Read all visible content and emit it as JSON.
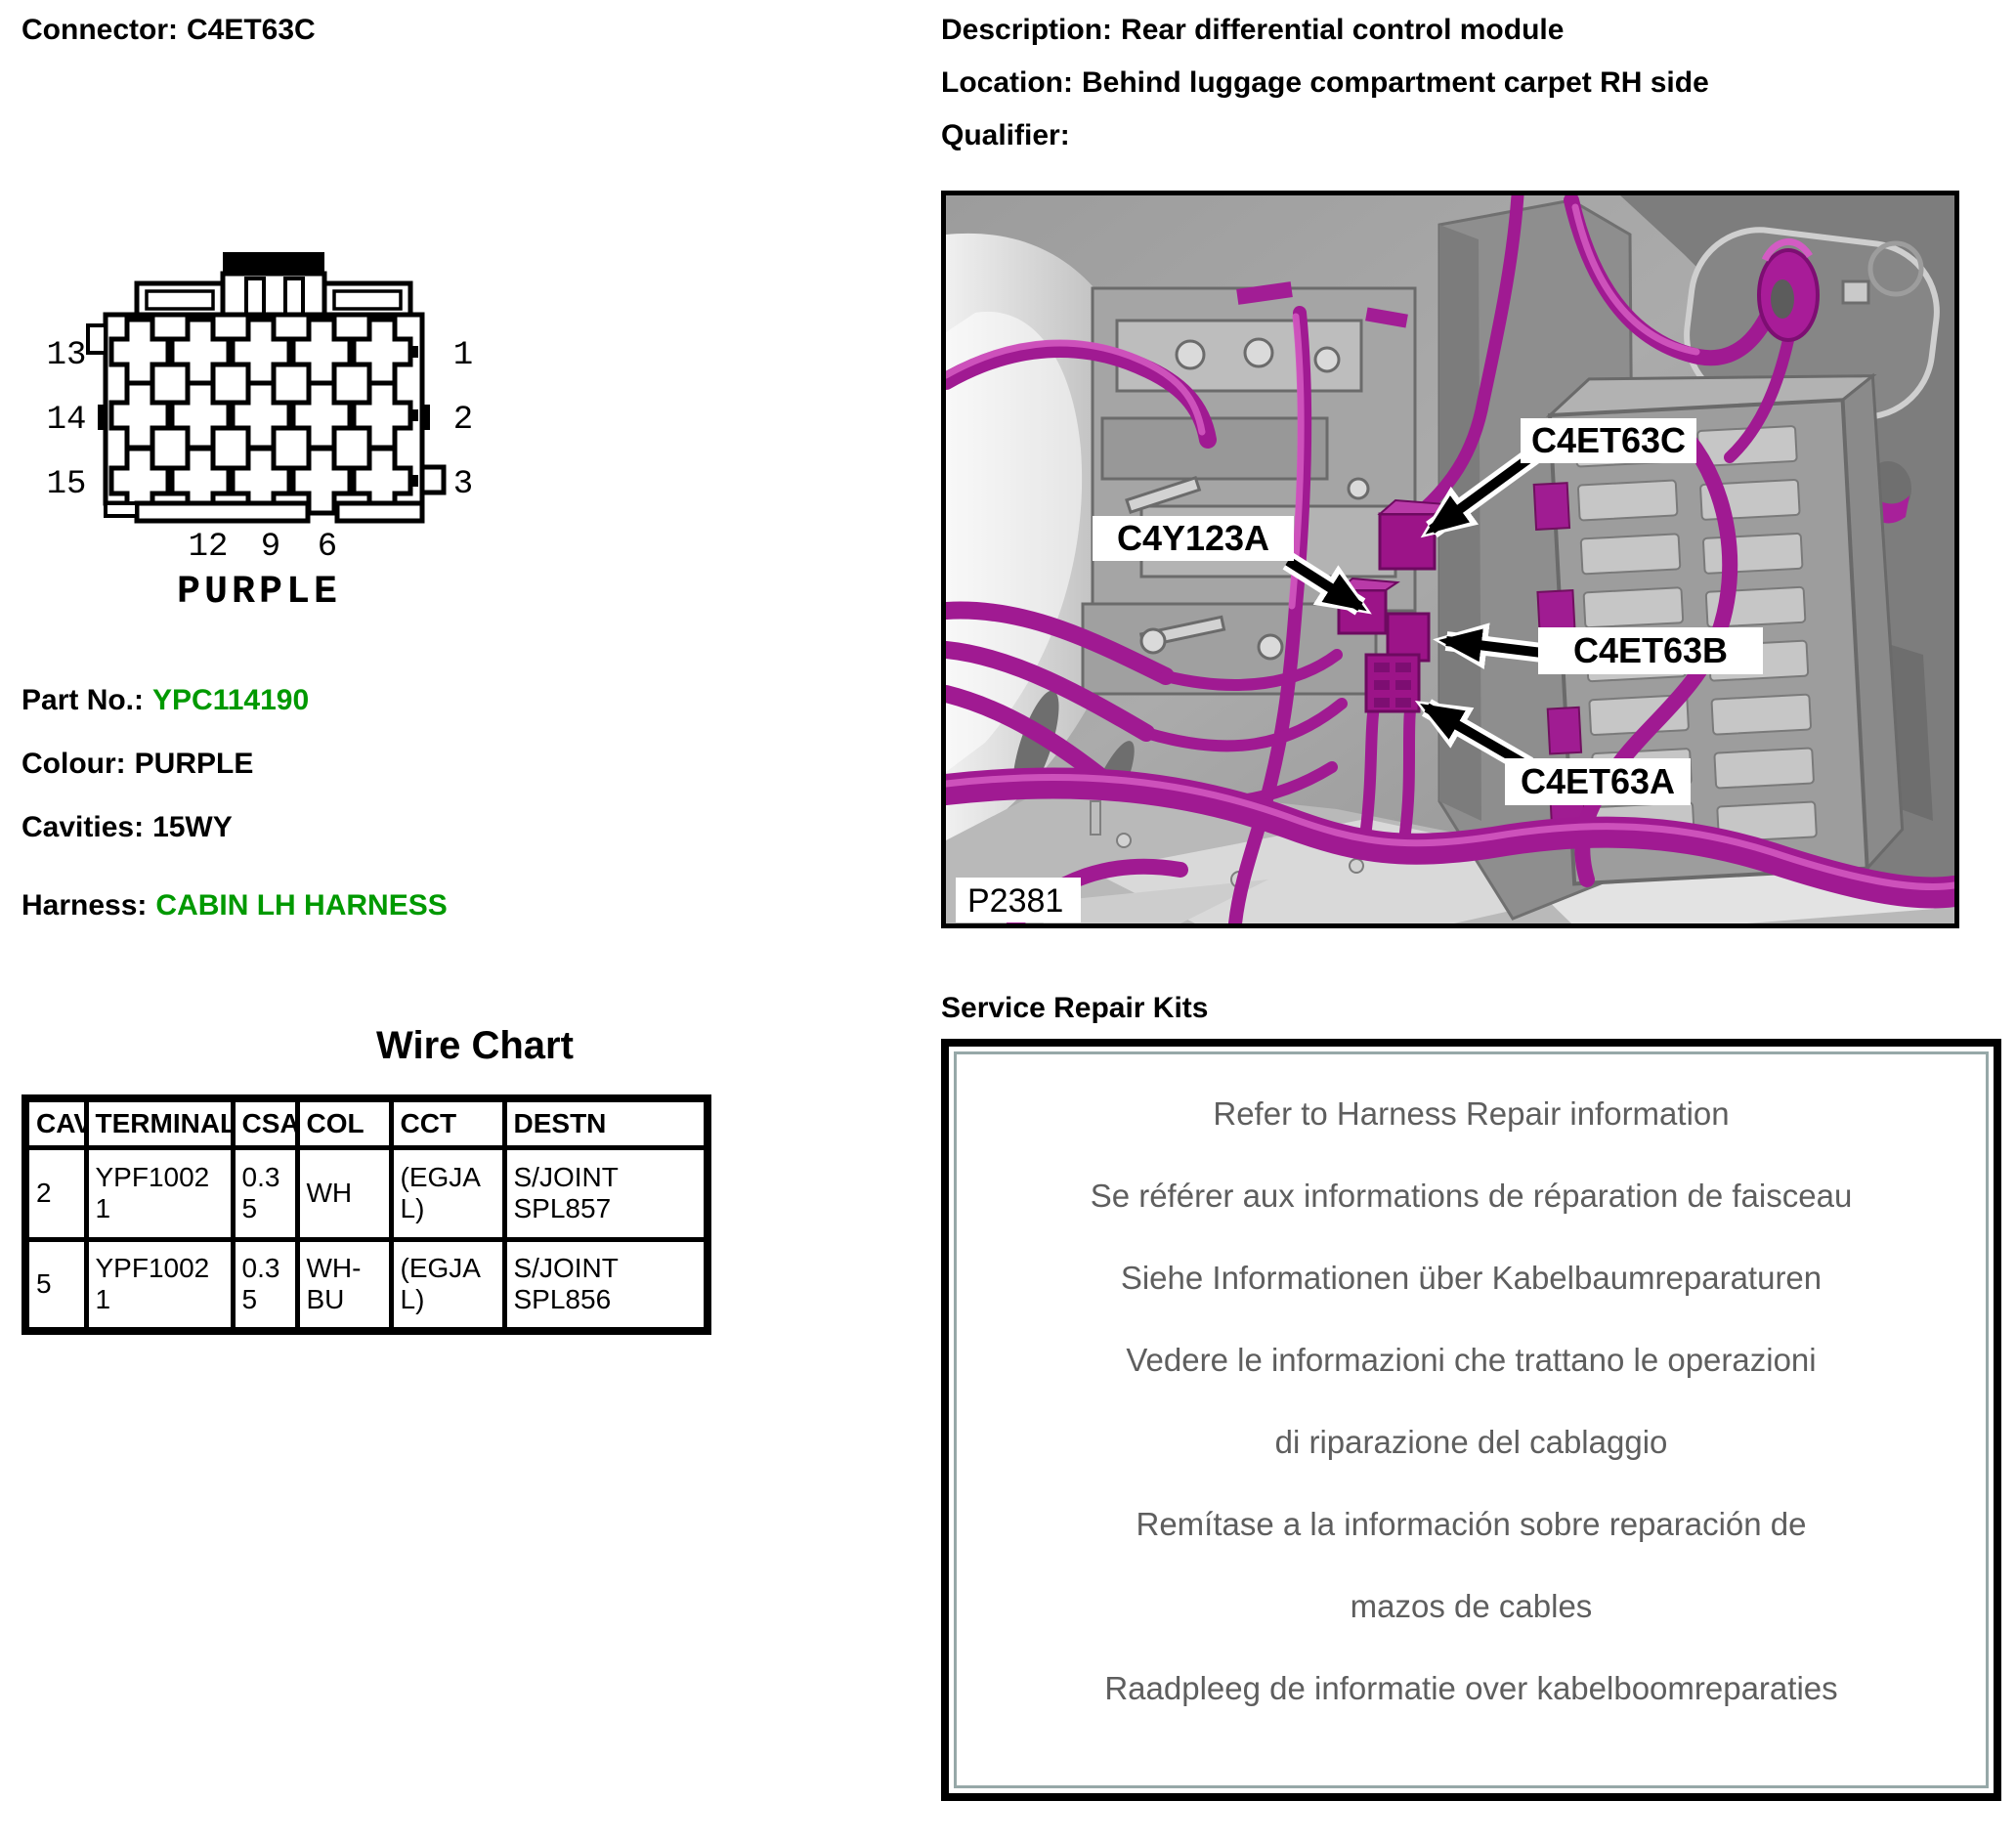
{
  "header": {
    "connector": {
      "label": "Connector:",
      "value": "C4ET63C"
    },
    "description": {
      "label": "Description:",
      "value": "Rear differential control module"
    },
    "location": {
      "label": "Location:",
      "value": "Behind luggage compartment carpet RH side"
    },
    "qualifier": {
      "label": "Qualifier:",
      "value": ""
    }
  },
  "connector_diagram": {
    "left_pins": [
      "13",
      "14",
      "15"
    ],
    "right_pins": [
      "1",
      "2",
      "3"
    ],
    "bottom_pins": [
      "12",
      "9",
      "6"
    ],
    "colour_label": "PURPLE"
  },
  "part_info": {
    "part_no": {
      "label": "Part No.:",
      "value": "YPC114190"
    },
    "colour": {
      "label": "Colour:",
      "value": "PURPLE"
    },
    "cavities": {
      "label": "Cavities:",
      "value": "15WY"
    },
    "harness": {
      "label": "Harness:",
      "value": "CABIN LH HARNESS"
    }
  },
  "wire_chart": {
    "title": "Wire Chart",
    "columns": [
      "CAV",
      "TERMINAL",
      "CSA",
      "COL",
      "CCT",
      "DESTN"
    ],
    "rows": [
      {
        "cav": "2",
        "terminal": "YPF10021",
        "csa": "0.35",
        "col": "WH",
        "cct": "(EGJAL)",
        "destn": "S/JOINT SPL857"
      },
      {
        "cav": "5",
        "terminal": "YPF10021",
        "csa": "0.35",
        "col": "WH-BU",
        "cct": "(EGJAL)",
        "destn": "S/JOINT SPL856"
      }
    ]
  },
  "photo": {
    "figure_id": "P2381",
    "callouts": {
      "c": "C4ET63C",
      "y": "C4Y123A",
      "b": "C4ET63B",
      "a": "C4ET63A"
    }
  },
  "service_repair_kits": {
    "title": "Service Repair Kits",
    "lines": [
      "Refer to Harness Repair information",
      "Se référer aux informations de réparation de faisceau",
      "Siehe Informationen über Kabelbaumreparaturen",
      "Vedere le informazioni che trattano le operazioni",
      "di riparazione del cablaggio",
      "Remítase a la información sobre reparación de",
      "mazos de cables",
      "Raadpleeg de informatie over kabelboomreparaties"
    ]
  },
  "colors": {
    "accent_green": "#009900",
    "wire_purple": "#A01A92",
    "connector_purple": "#9C1488",
    "repair_text_gray": "#5E5E5E",
    "repair_box_inner_border": "#96A8A8"
  }
}
